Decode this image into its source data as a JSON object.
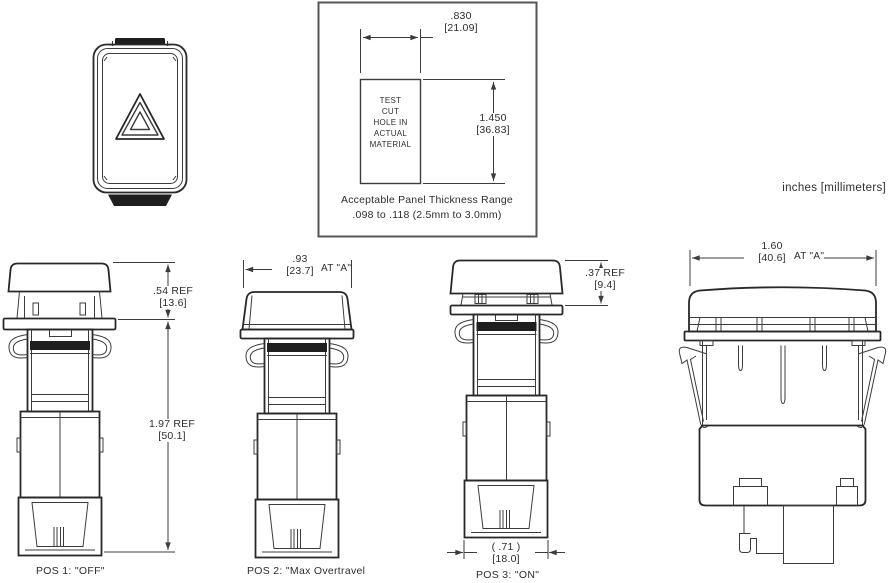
{
  "units_note": "inches [millimeters]",
  "cutout": {
    "width_in": ".830",
    "width_mm": "[21.09]",
    "height_in": "1.450",
    "height_mm": "[36.83]",
    "hole_text": [
      "TEST",
      "CUT",
      "HOLE IN",
      "ACTUAL",
      "MATERIAL"
    ],
    "note1": "Acceptable Panel Thickness Range",
    "note2": ".098 to .118 (2.5mm to 3.0mm)"
  },
  "pos1": {
    "dim1_in": ".54 REF",
    "dim1_mm": "[13.6]",
    "dim2_in": "1.97 REF",
    "dim2_mm": "[50.1]",
    "caption": "POS 1: \"OFF\""
  },
  "pos2": {
    "dim_in": ".93",
    "dim_mm": "[23.7]",
    "dim_at": "AT \"A\"",
    "caption": "POS 2: \"Max Overtravel"
  },
  "pos3": {
    "dim1_in": ".37 REF",
    "dim1_mm": "[9.4]",
    "dim2_in": "( .71 )",
    "dim2_mm": "[18.0]",
    "caption": "POS 3: \"ON\""
  },
  "side": {
    "dim_in": "1.60",
    "dim_mm": "[40.6]",
    "dim_at": "AT \"A\""
  },
  "colors": {
    "line": "#3c3c3c",
    "line_strong": "#282828",
    "fill_dark": "#1f1f1f",
    "frame": "#555555",
    "text": "#2e2e2e",
    "background": "#ffffff"
  }
}
